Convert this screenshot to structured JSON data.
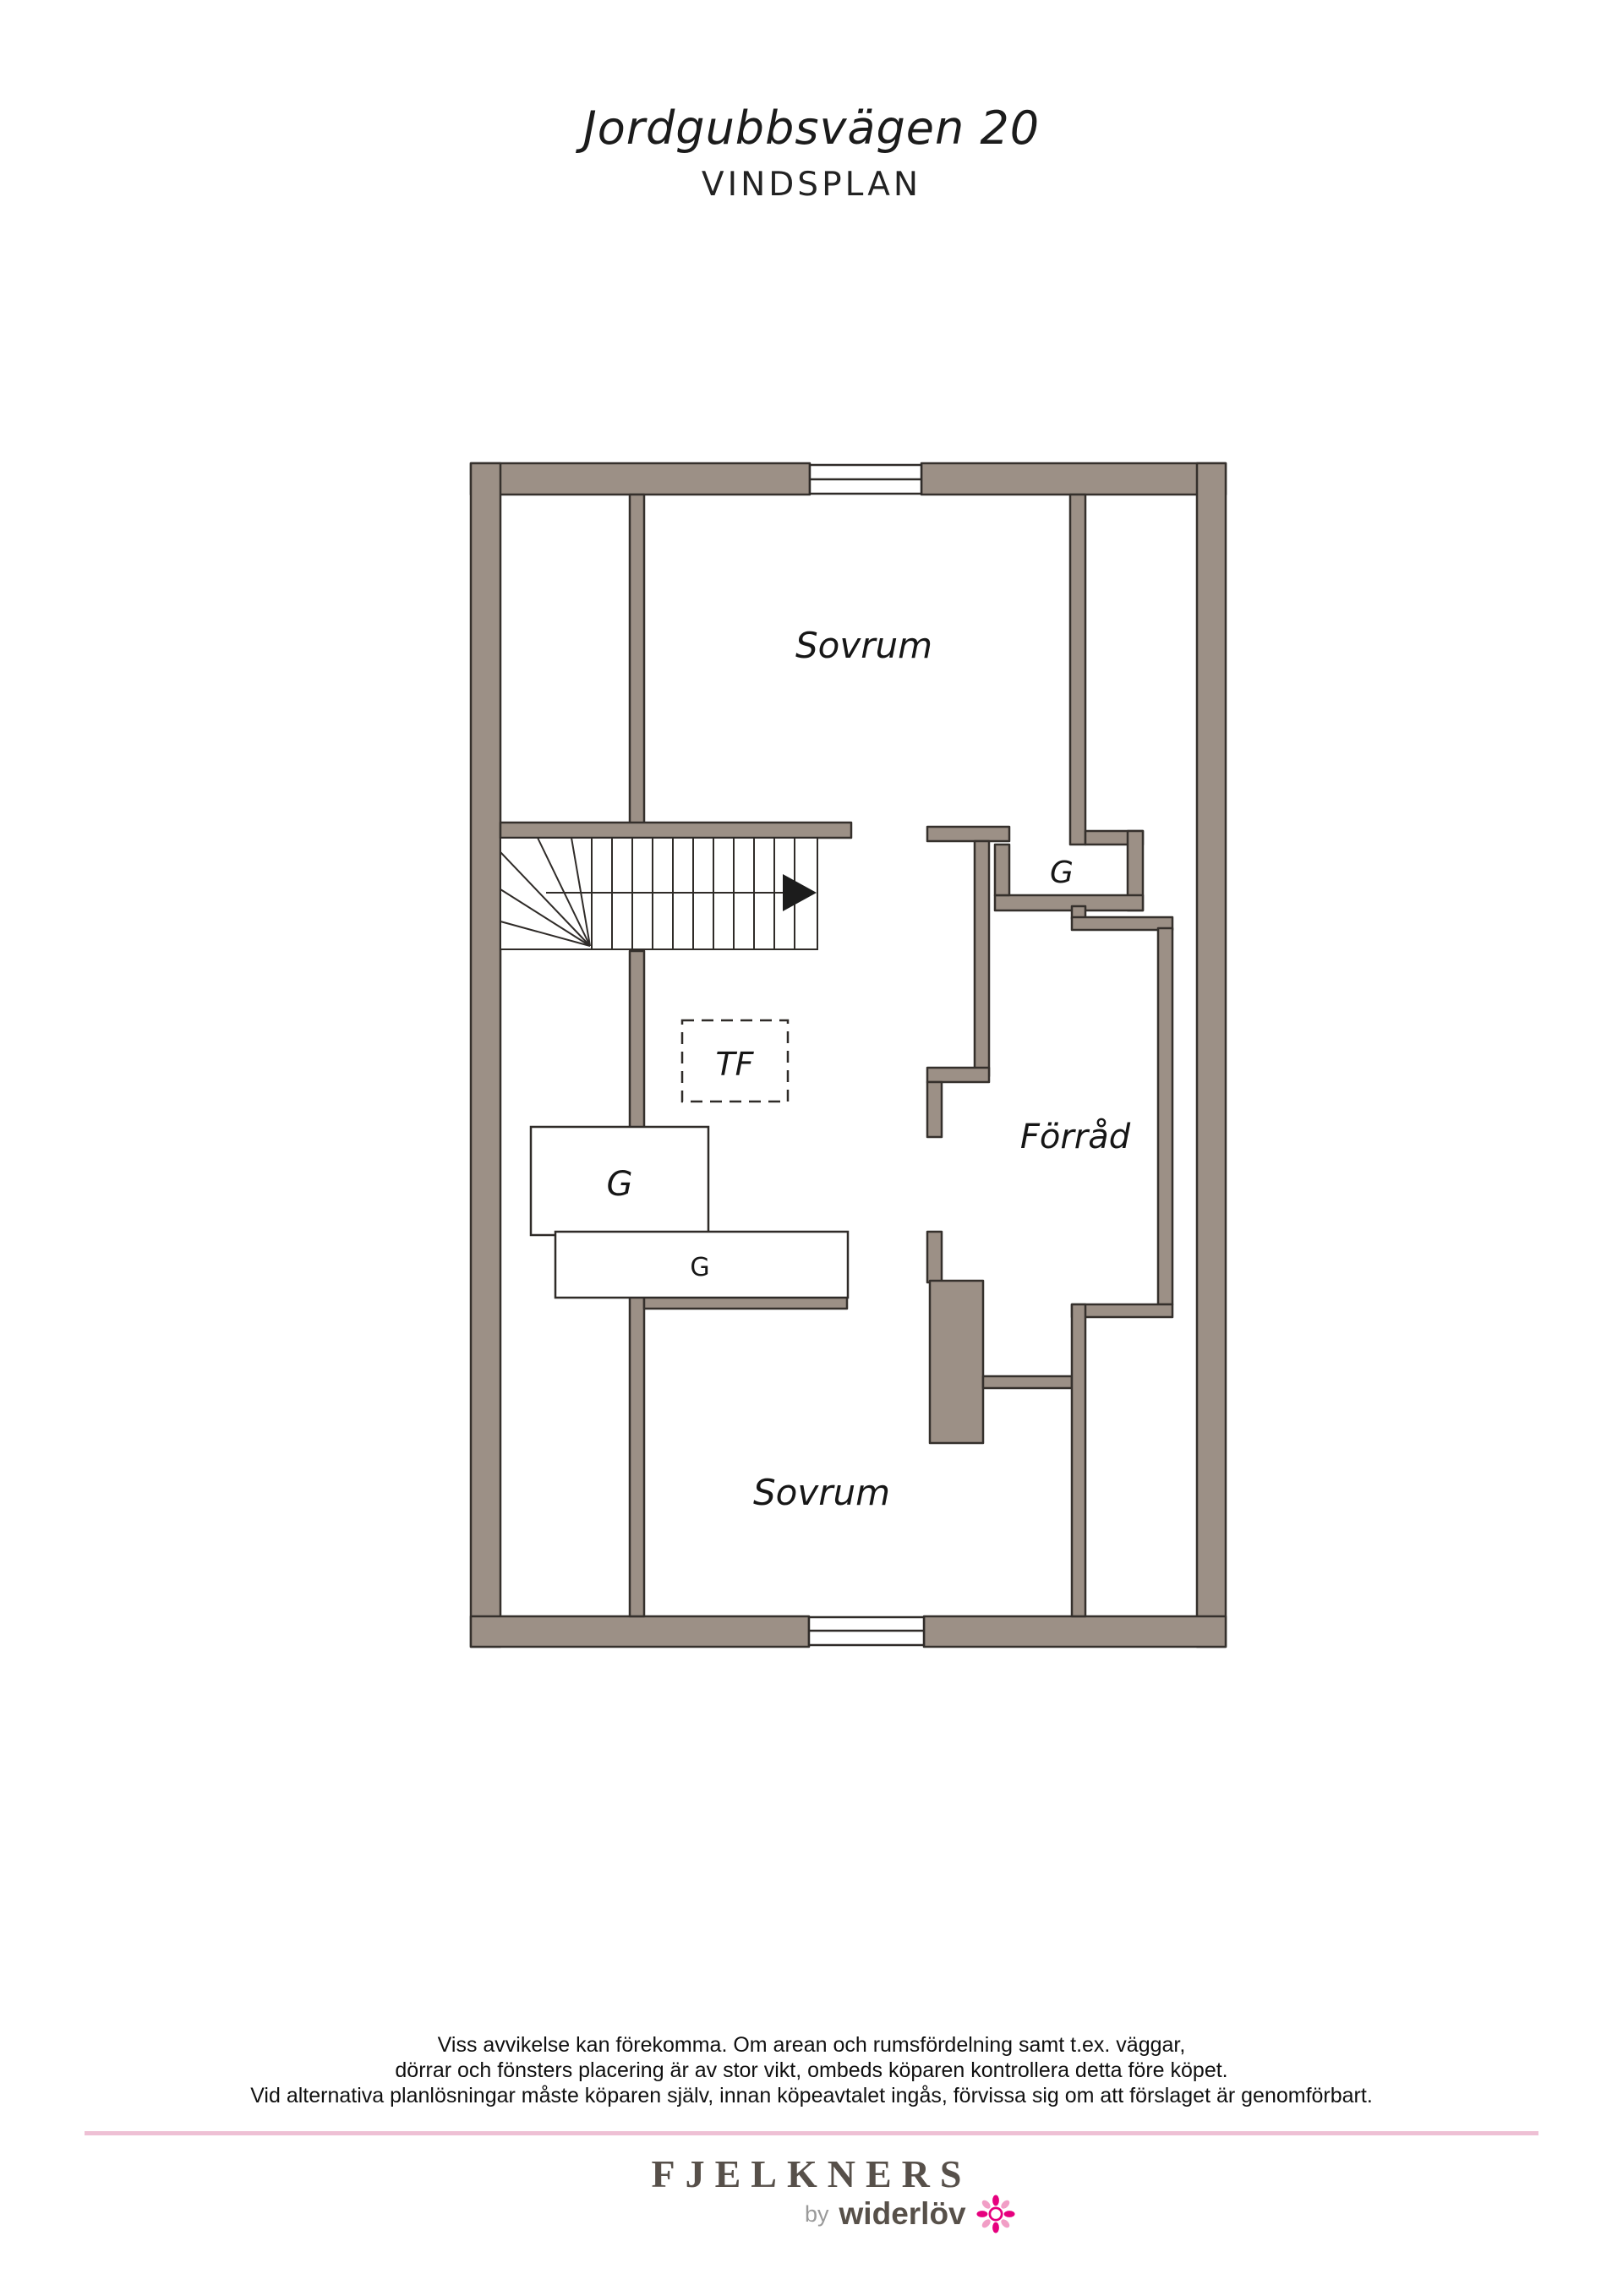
{
  "header": {
    "title": "Jordgubbsvägen 20",
    "subtitle": "VINDSPLAN"
  },
  "plan": {
    "colors": {
      "wall_fill": "#9c9086",
      "outline": "#35302c",
      "label": "#161616"
    },
    "labels": {
      "bedroom_top": "Sovrum",
      "bedroom_bottom": "Sovrum",
      "storage": "Förråd",
      "closet_g": "G",
      "wardrobe_g_large": "G",
      "wardrobe_g_small": "G",
      "tf": "TF"
    }
  },
  "footer": {
    "disclaimer_lines": [
      "Viss avvikelse kan förekomma. Om arean och rumsfördelning samt t.ex. väggar,",
      "dörrar och fönsters placering är av stor vikt, ombeds köparen kontrollera detta före köpet.",
      "Vid alternativa planlösningar måste köparen själv, innan köpeavtalet ingås, förvissa sig om att förslaget är genomförbart."
    ],
    "divider_color": "#eec0d4"
  },
  "brand": {
    "name": "FJELKNERS",
    "byline_prefix": "by",
    "byline_name": "widerlöv",
    "flower_color": "#e6007e"
  }
}
